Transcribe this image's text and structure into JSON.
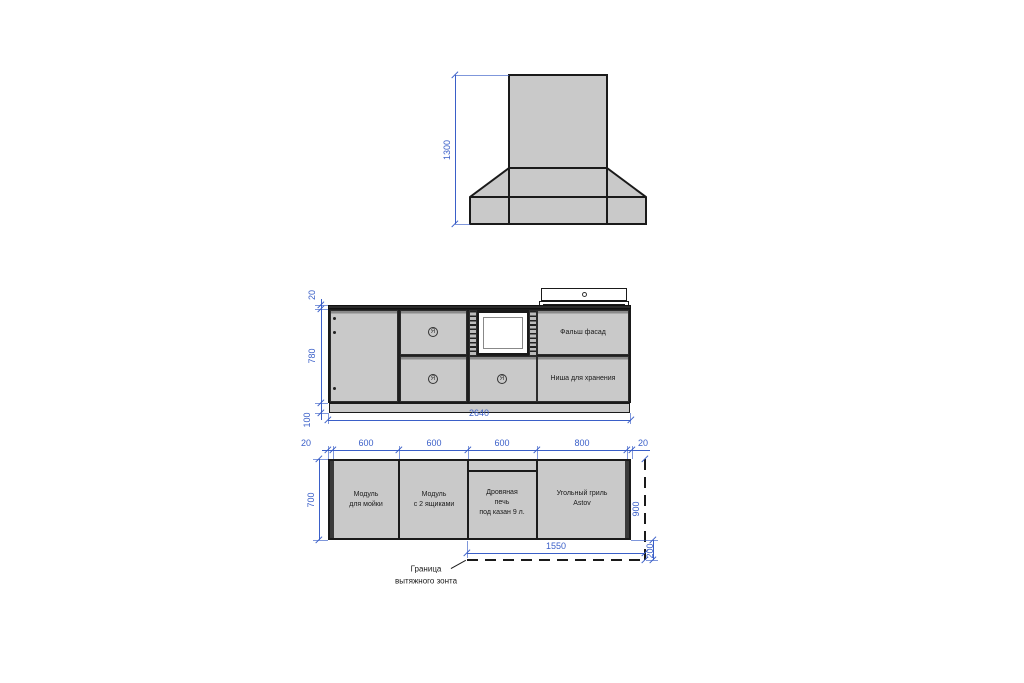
{
  "colors": {
    "line": "#1a1a1a",
    "fill": "#c9c9c9",
    "dim": "#3a5fc8",
    "bevel": "#8a8a8a",
    "white": "#ffffff"
  },
  "hood_view": {
    "dim_height": "1300"
  },
  "front_view": {
    "dim_countertop_thickness": "20",
    "dim_body_height": "780",
    "dim_plinth_height": "100",
    "dim_total_width": "2640",
    "label_false_facade": "Фальш фасад",
    "label_storage_niche": "Ниша для хранения",
    "knob_symbol": "Я"
  },
  "plan_view": {
    "dim_side_left": "20",
    "dim_module_1": "600",
    "dim_module_2": "600",
    "dim_module_3": "600",
    "dim_module_4": "800",
    "dim_side_right": "20",
    "dim_depth": "700",
    "dim_hood_depth": "900",
    "dim_hood_overhang": "200",
    "dim_hood_width": "1550",
    "module_1_label": "Модуль\nдля мойки",
    "module_2_label": "Модуль\nс 2 ящиками",
    "module_3_label": "Дровяная\nпечь\nпод казан 9 л.",
    "module_4_label": "Угольный гриль\nAstov",
    "callout_hood_boundary": "Граница\nвытяжного зонта"
  }
}
